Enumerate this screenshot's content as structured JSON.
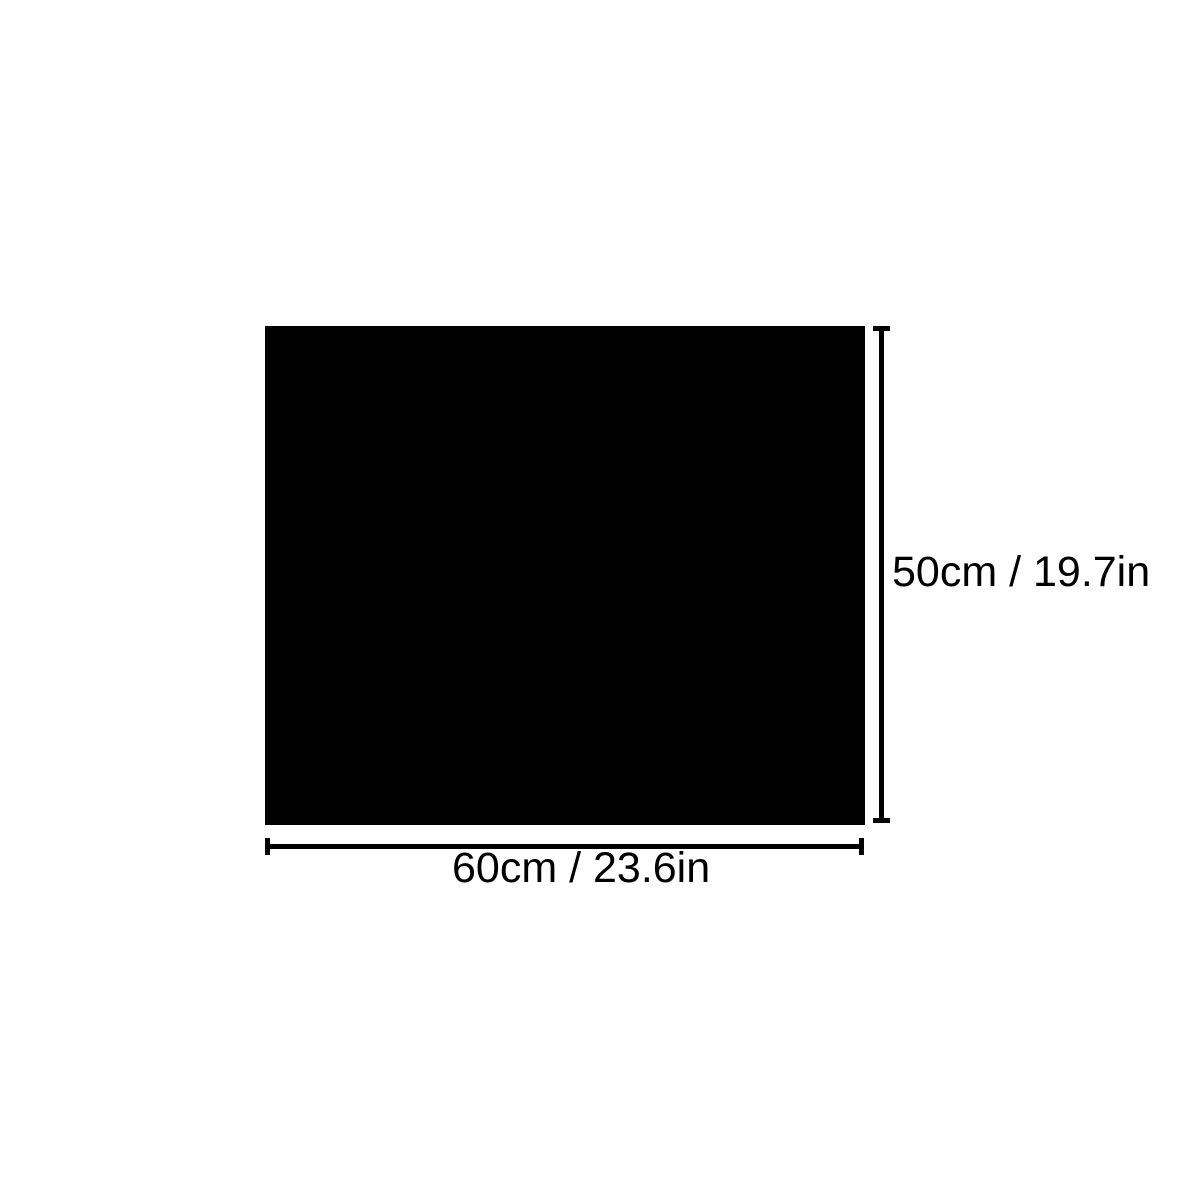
{
  "diagram": {
    "type": "product-dimension-diagram",
    "colors": {
      "background": "#ffffff",
      "product": "#000000",
      "dimension_lines": "#000000",
      "label_text": "#000000"
    },
    "product": {
      "description": "solid black rectangular sheet"
    },
    "height_dimension": {
      "label": "50cm / 19.7in",
      "cm": 50,
      "in": 19.7,
      "orientation": "vertical",
      "position": "right-of-product"
    },
    "width_dimension": {
      "label": "60cm / 23.6in",
      "cm": 60,
      "in": 23.6,
      "orientation": "horizontal",
      "position": "below-product"
    }
  }
}
